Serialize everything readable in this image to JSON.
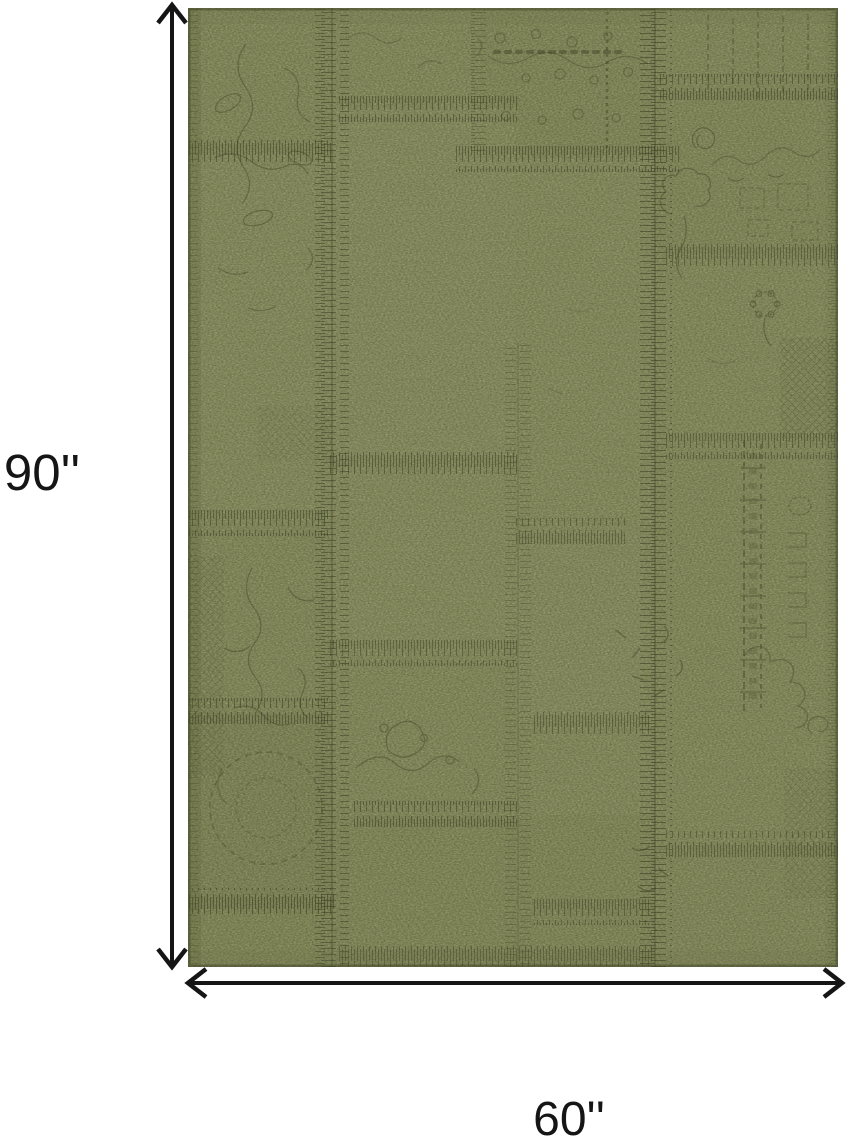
{
  "diagram": {
    "dimensions": {
      "height_label": "90''",
      "width_label": "60''"
    },
    "icons": {
      "vertical_arrow": "double-headed-arrow-vertical",
      "horizontal_arrow": "double-headed-arrow-horizontal"
    },
    "colors": {
      "background": "#ffffff",
      "arrow": "#151515",
      "label_text": "#151515",
      "rug_base": "#a3a776",
      "rug_light_patch": "#b0b383",
      "rug_dark_patch": "#7d8451",
      "rug_highlight_fleck": "#c9caa0",
      "stitch": "#363c20"
    }
  }
}
